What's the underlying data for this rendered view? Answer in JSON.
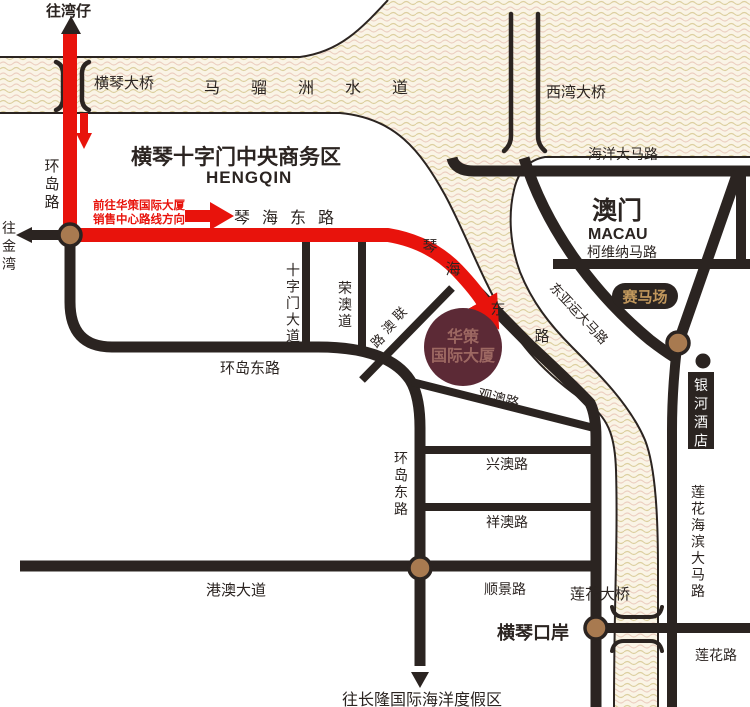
{
  "map_title": "华策国际大厦位置示意图",
  "colors": {
    "route_red": "#e8130c",
    "road_dark": "#2b2421",
    "node_brown": "#a87a50",
    "water_bg": "#faf4e6",
    "wave_tan": "#dccf9f",
    "wave_pink": "#eccfc1",
    "building_fill": "#5c2a36",
    "building_text": "#9d6862",
    "badge_bg": "#2b2421",
    "badge_gold_text": "#c1975c"
  },
  "labels": {
    "to_wanzai": "往湾仔",
    "hengqin_bridge": "横琴大桥",
    "maliuzhou_waterway": "马骝洲水道",
    "xiwan_bridge": "西湾大桥",
    "haiyang_avenue": "海洋大马路",
    "huandao_road": "环岛路",
    "to_jinwan": "往金湾",
    "cbd_title": "横琴十字门中央商务区",
    "cbd_subtitle": "HENGQIN",
    "route_note_line1": "前往华策国际大厦",
    "route_note_line2": "销售中心路线方向",
    "qinhai_east_road": "琴海东路",
    "macau_cn": "澳门",
    "macau_en": "MACAU",
    "kewei_na_road": "柯维纳马路",
    "racecourse": "赛马场",
    "dongyayun_avenue": "东亚运大马路",
    "shizimen_avenue": "十字门大道",
    "rongao_road": "荣澳道",
    "huandao_east_road_h": "环岛东路",
    "huandao_east_road_v": "环岛东路",
    "guanao_road": "观澳路",
    "xingao_road": "兴澳路",
    "xiangao_road": "祥澳路",
    "gangao_avenue": "港澳大道",
    "shunjing_road": "顺景路",
    "hengqin_port": "横琴口岸",
    "lianhua_bridge": "莲花大桥",
    "lianhua_road": "莲花路",
    "lianhua_coastal_avenue": "莲花海滨大马路",
    "galaxy_hotel": "银河酒店",
    "to_changlong": "往长隆国际海洋度假区"
  },
  "building": {
    "line1": "华策",
    "line2": "国际大厦"
  },
  "qinhai_diag_chars": [
    "琴",
    "海",
    "东",
    "路"
  ],
  "lianao_chars": [
    "联",
    "澳",
    "路"
  ]
}
